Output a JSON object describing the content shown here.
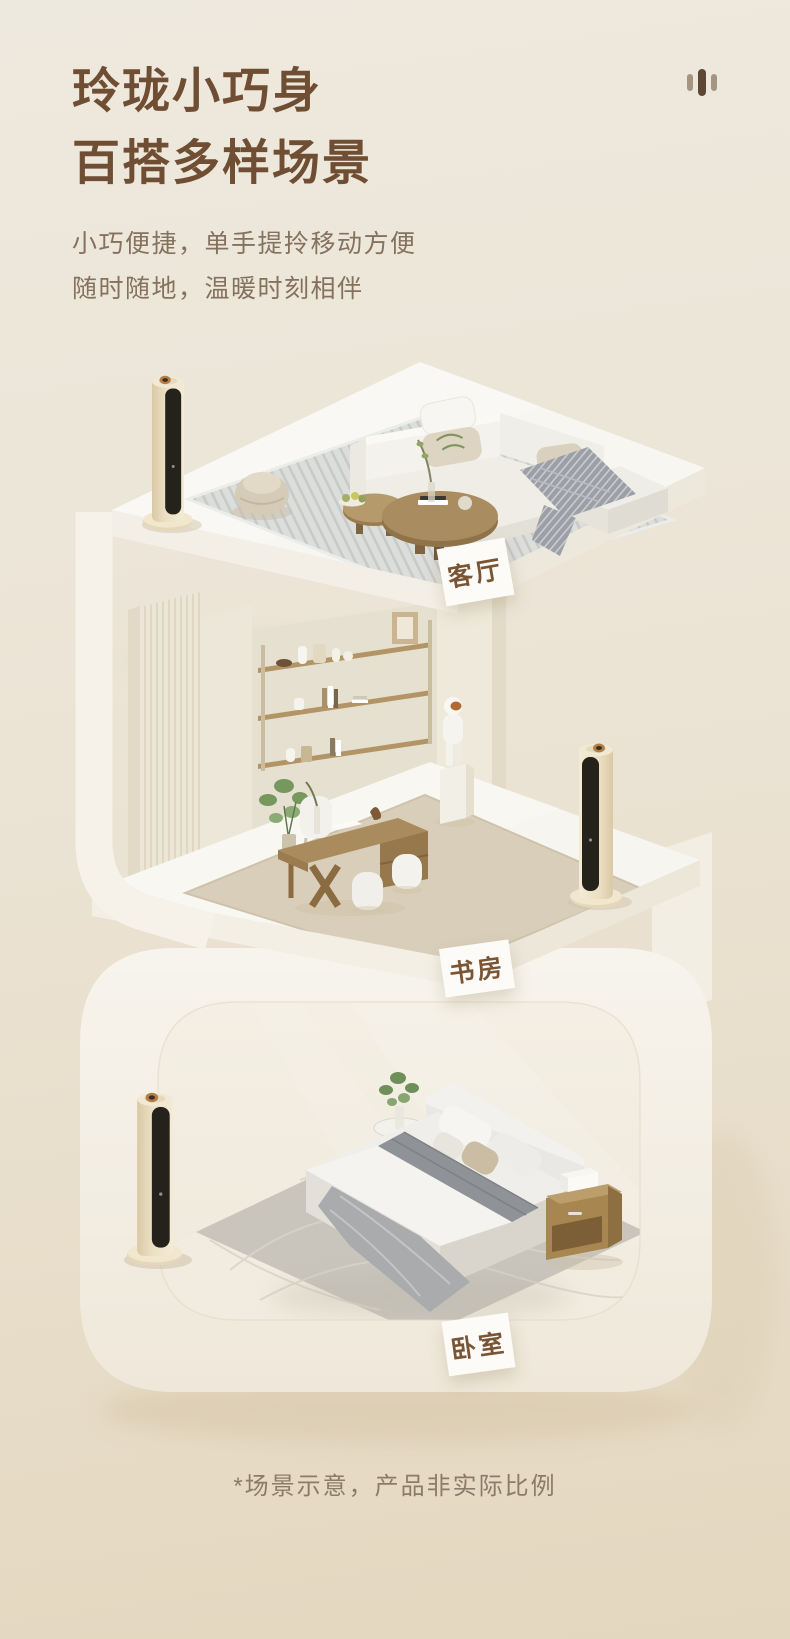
{
  "header": {
    "title_line1": "玲珑小巧身",
    "title_line2": "百搭多样场景",
    "subtitle_line1": "小巧便捷，单手提拎移动方便",
    "subtitle_line2": "随时随地，温暖时刻相伴",
    "decor_icon": "equalizer-bars-icon"
  },
  "scenes": [
    {
      "id": "living-room",
      "label": "客厅"
    },
    {
      "id": "study",
      "label": "书房"
    },
    {
      "id": "bedroom",
      "label": "卧室"
    }
  ],
  "footer": {
    "disclaimer": "*场景示意，产品非实际比例"
  },
  "colors": {
    "background_top": "#EEE9DE",
    "background_bottom": "#E4D7BF",
    "title_text": "#6F4E33",
    "subtitle_text": "#85725E",
    "label_text": "#7A5535",
    "label_card_bg": "#FCFBF7",
    "structure_white": "#F7F4ED",
    "fan_body_cream": "#EFE5CC",
    "fan_front_panel": "#25211B",
    "fan_knob_copper": "#B47E48",
    "wood_tone": "#A98C5F",
    "disclaimer_text": "#8C7B69"
  }
}
